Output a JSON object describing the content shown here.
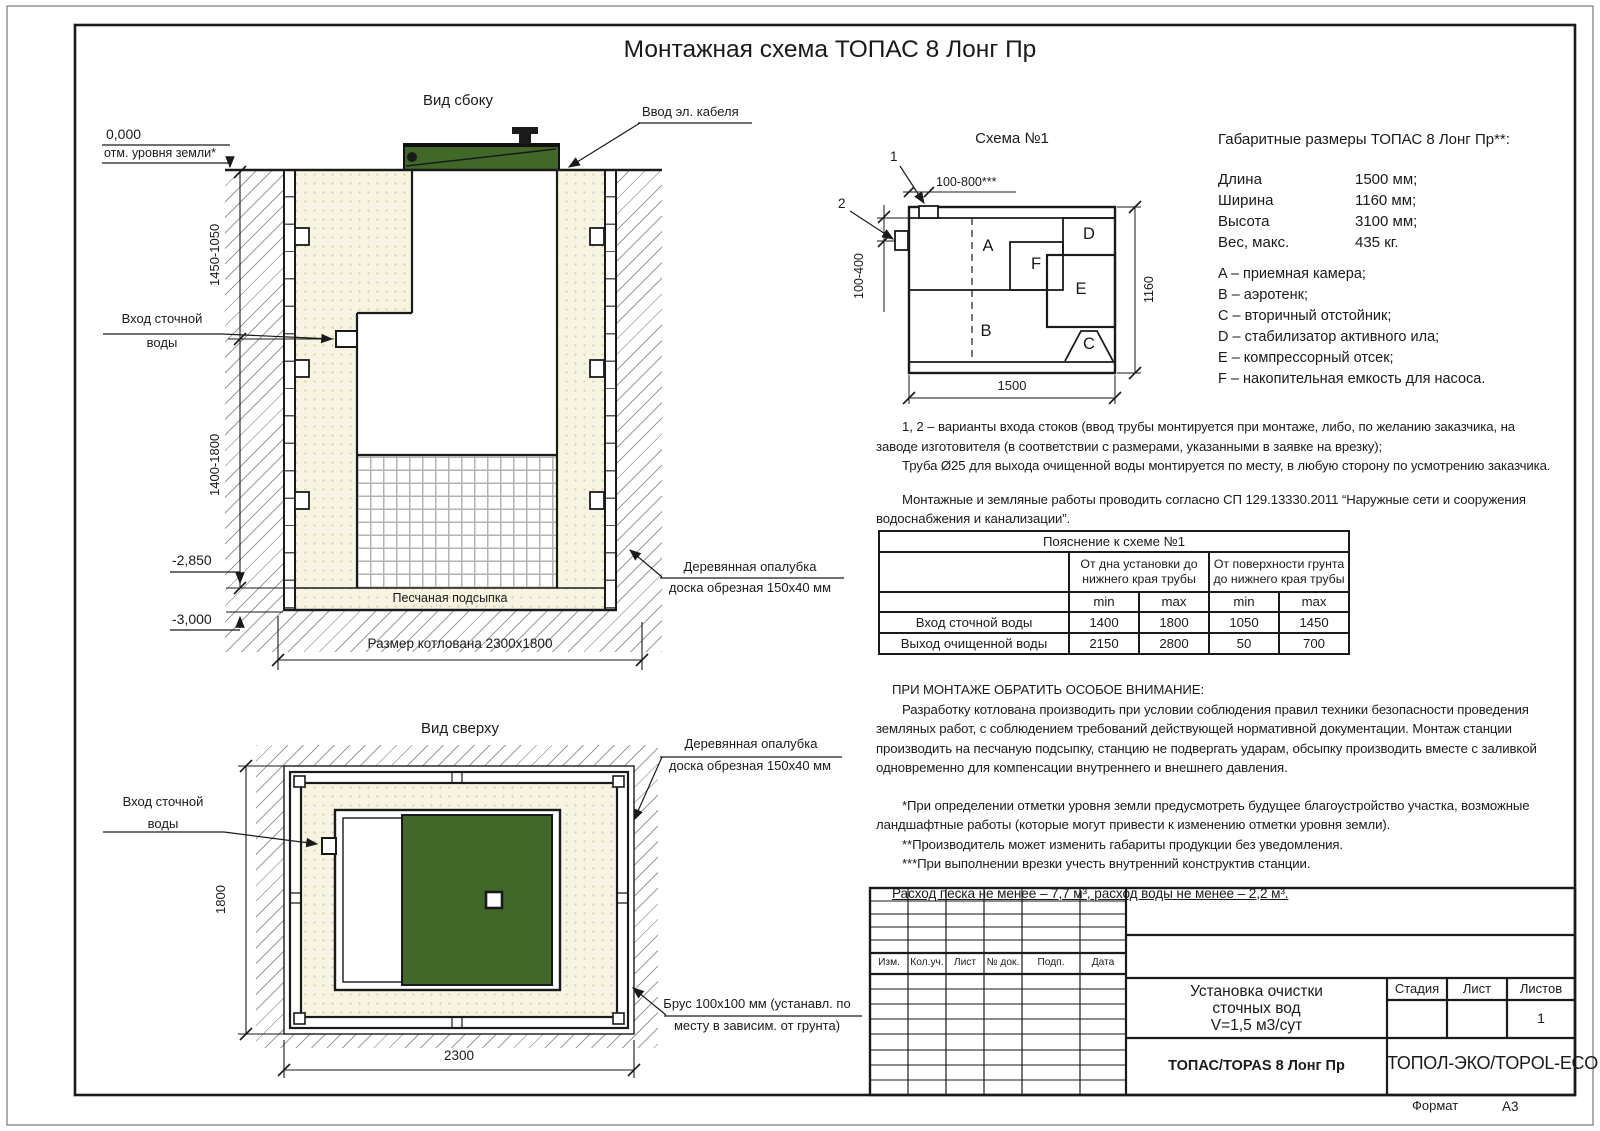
{
  "doc": {
    "title": "Монтажная схема ТОПАС 8 Лонг Пр"
  },
  "side_view": {
    "title": "Вид сбоку",
    "zero_mark": "0,000",
    "zero_sub": "отм. уровня земли*",
    "dim_upper": "1450-1050",
    "dim_lower": "1400-1800",
    "elev_mid": "-2,850",
    "elev_bottom": "-3,000",
    "inlet_line1": "Вход сточной",
    "inlet_line2": "воды",
    "cable": "Ввод эл. кабеля",
    "formwork_line1": "Деревянная опалубка",
    "formwork_line2": "доска обрезная 150x40 мм",
    "sand": "Песчаная подсыпка",
    "pit_dim": "Размер котлована 2300x1800"
  },
  "top_view": {
    "title": "Вид сверху",
    "inlet_line1": "Вход сточной",
    "inlet_line2": "воды",
    "dim_height": "1800",
    "dim_width": "2300",
    "formwork_line1": "Деревянная опалубка",
    "formwork_line2": "доска обрезная 150x40 мм",
    "beam_line1": "Брус 100x100 мм (устанавл. по",
    "beam_line2": "месту в зависим. от грунта)"
  },
  "schema": {
    "title": "Схема №1",
    "marker1": "1",
    "marker2": "2",
    "dim_top": "100-800***",
    "dim_left": "100-400",
    "dim_width": "1500",
    "dim_height": "1160",
    "comp_a": "A",
    "comp_b": "B",
    "comp_c": "C",
    "comp_d": "D",
    "comp_e": "E",
    "comp_f": "F"
  },
  "specs": {
    "title": "Габаритные размеры ТОПАС 8 Лонг Пр**:",
    "rows": [
      {
        "label": "Длина",
        "value": "1500 мм;"
      },
      {
        "label": "Ширина",
        "value": "1160 мм;"
      },
      {
        "label": "Высота",
        "value": "3100 мм;"
      },
      {
        "label": "Вес, макс.",
        "value": "435 кг."
      }
    ],
    "legend": [
      "A – приемная камера;",
      "B – аэротенк;",
      "C – вторичный отстойник;",
      "D – стабилизатор активного ила;",
      "E – компрессорный отсек;",
      "F – накопительная емкость для насоса."
    ]
  },
  "notes": {
    "p1": "1, 2 – варианты входа  стоков (ввод трубы монтируется при монтаже, либо, по желанию заказчика, на заводе изготовителя (в соответствии с размерами, указанными в заявке на врезку);",
    "p2": "Труба Ø25 для выхода очищенной воды монтируется по месту, в любую сторону по усмотрению заказчика.",
    "p3": "Монтажные и земляные работы проводить согласно СП 129.13330.2011 “Наружные сети и сооружения водоснабжения и канализации”."
  },
  "table": {
    "title": "Пояснение к схеме №1",
    "group1": "От дна установки до нижнего края трубы",
    "group2": "От поверхности грунта до нижнего края трубы",
    "min": "min",
    "max": "max",
    "rows": [
      {
        "label": "Вход сточной воды",
        "c1": "1400",
        "c2": "1800",
        "c3": "1050",
        "c4": "1450"
      },
      {
        "label": "Выход очищенной воды",
        "c1": "2150",
        "c2": "2800",
        "c3": "50",
        "c4": "700"
      }
    ]
  },
  "attention": {
    "heading": "ПРИ МОНТАЖЕ ОБРАТИТЬ ОСОБОЕ ВНИМАНИЕ:",
    "body": "Разработку котлована производить при условии соблюдения правил техники безопасности проведения земляных работ, с соблюдением требований действующей нормативной документации. Монтаж станции производить на песчаную подсыпку, станцию не подвергать ударам, обсыпку производить вместе с заливкой одновременно для компенсации внутреннего и внешнего давления.",
    "fn1": "*При определении отметки уровня земли предусмотреть будущее благоустройство участка, возможные ландшафтные работы (которые могут привести к изменению отметки уровня земли).",
    "fn2": "**Производитель может изменить габариты продукции без уведомления.",
    "fn3": "***При выполнении врезки учесть внутренний конструктив станции.",
    "consumption": "Расход песка не менее – 7,7 м³, расход воды не менее – 2,2 м³."
  },
  "title_block": {
    "headers": [
      "Изм.",
      "Кол.уч.",
      "Лист",
      "№ док.",
      "Подп.",
      "Дата"
    ],
    "doc_line1": "Установка очистки",
    "doc_line2": "сточных вод",
    "doc_line3": "V=1,5 м3/сут",
    "stage_label": "Стадия",
    "sheet_label": "Лист",
    "sheets_label": "Листов",
    "sheets_value": "1",
    "product": "ТОПАС/TOPAS 8 Лонг Пр",
    "company": "ТОПОЛ-ЭКО/TOPOL-ECO",
    "format_label": "Формат",
    "format_value": "А3"
  },
  "colors": {
    "lid_green": "#426829",
    "sand_base": "#f8f4e4",
    "sand_dot": "#d9cf9f",
    "hatch_line": "#9b9b9b",
    "line": "#1a1a1a"
  }
}
